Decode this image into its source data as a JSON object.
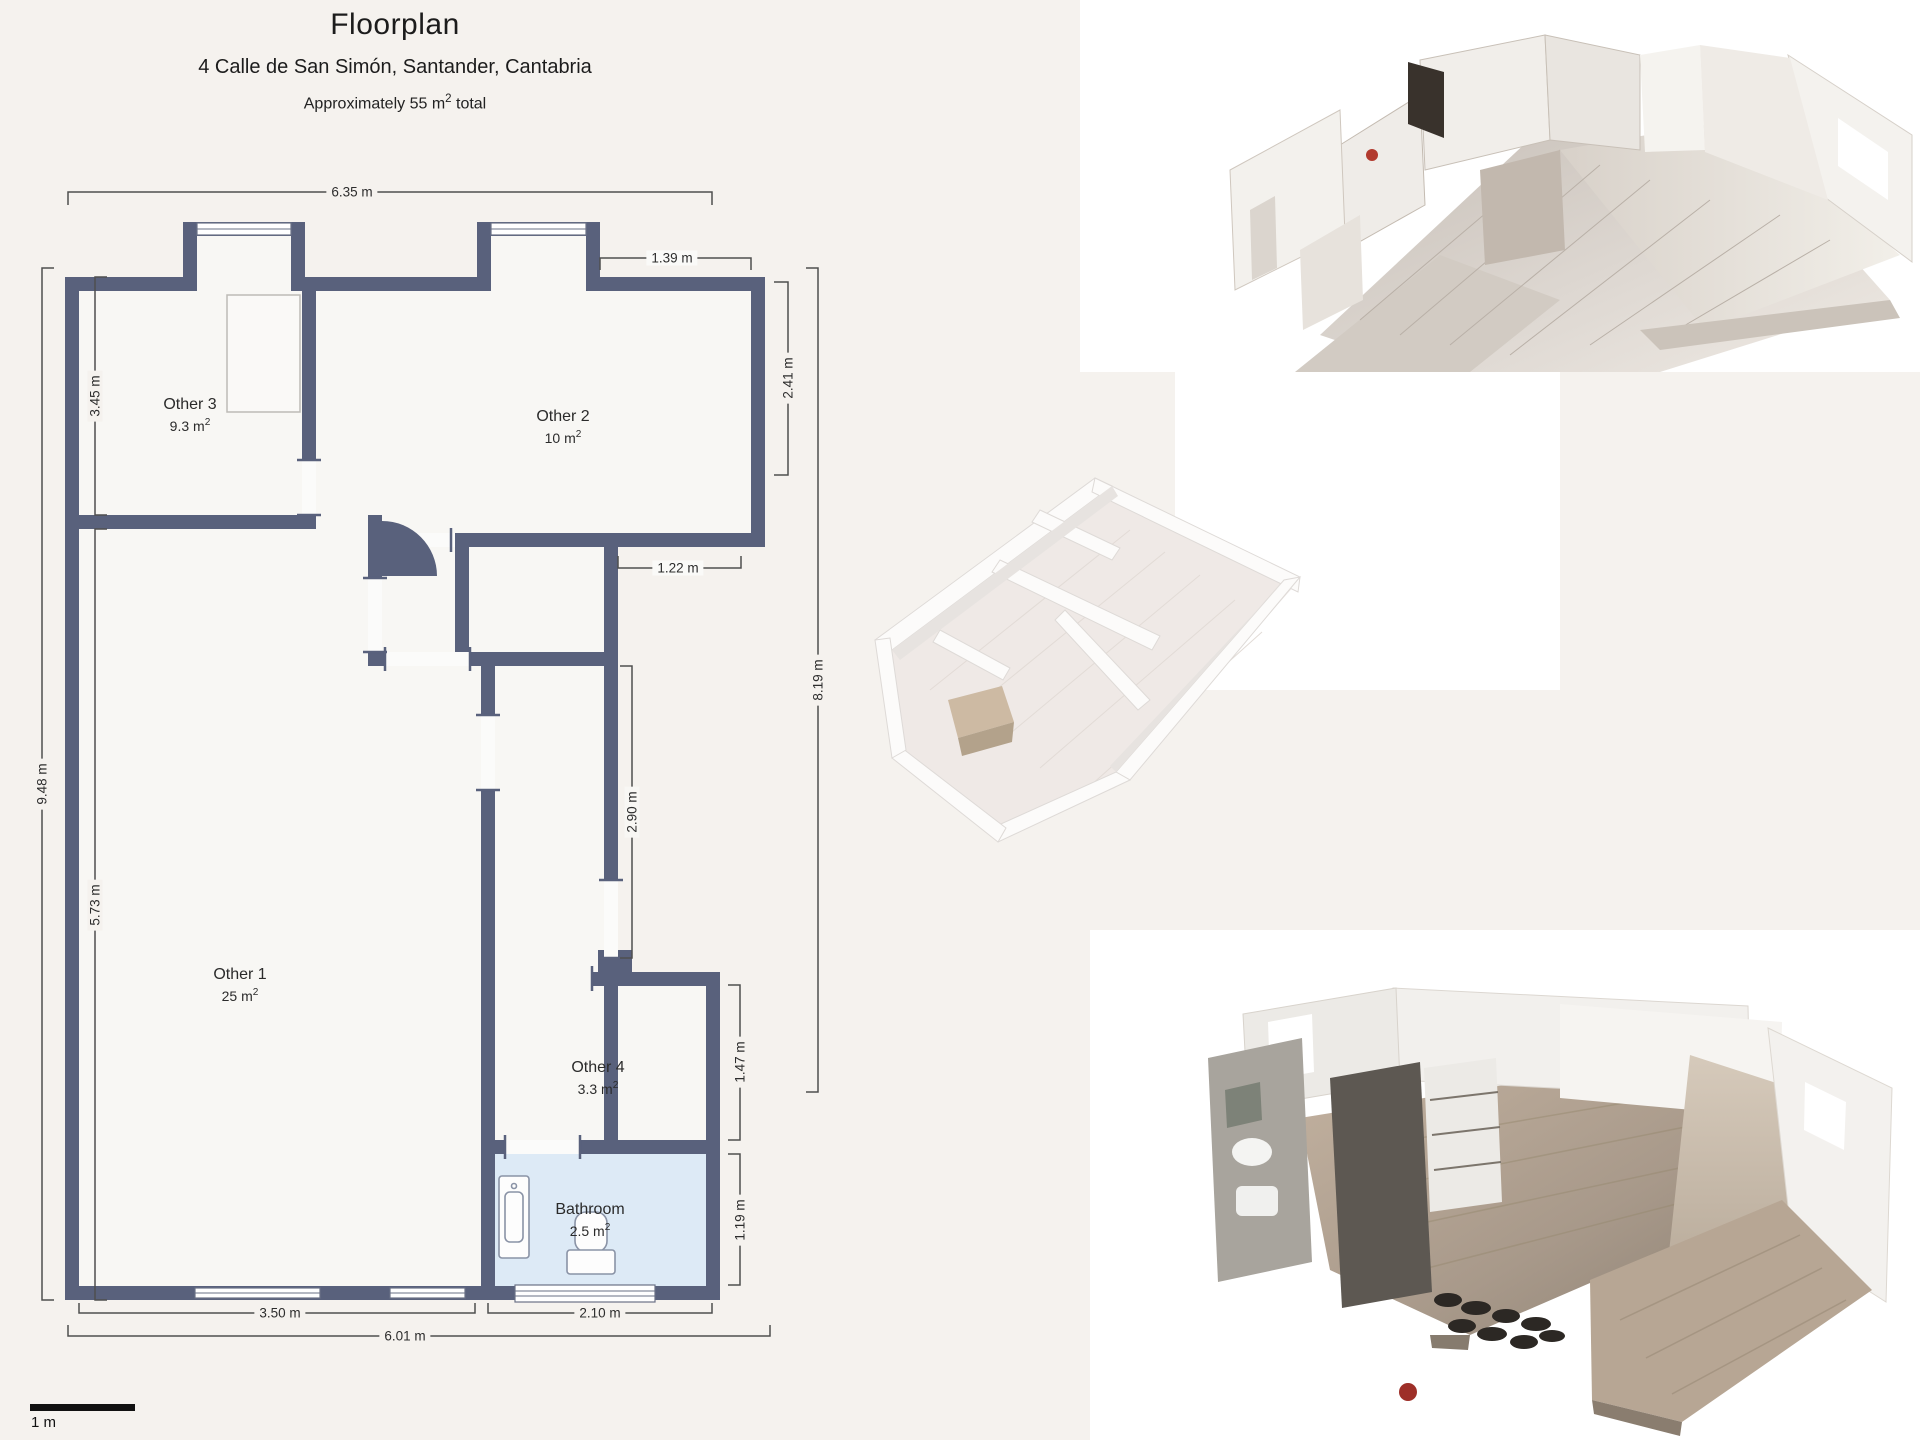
{
  "header": {
    "title": "Floorplan",
    "address": "4 Calle de San Simón, Santander, Cantabria",
    "area_total": {
      "prefix": "Approximately 55 m",
      "sup": "2",
      "suffix": " total"
    }
  },
  "floorplan": {
    "wall_color": "#59617c",
    "room_fill": "#f8f7f4",
    "bathroom_fill": "#ddeaf6",
    "dim_line_color": "#4f4f4f",
    "rooms": [
      {
        "name": "Other 3",
        "area_value": "9.3 m",
        "area_sup": "2"
      },
      {
        "name": "Other 2",
        "area_value": "10 m",
        "area_sup": "2"
      },
      {
        "name": "Other 1",
        "area_value": "25 m",
        "area_sup": "2"
      },
      {
        "name": "Other 4",
        "area_value": "3.3 m",
        "area_sup": "2"
      },
      {
        "name": "Bathroom",
        "area_value": "2.5 m",
        "area_sup": "2"
      }
    ],
    "dimensions": [
      {
        "label": "6.35 m"
      },
      {
        "label": "1.39 m"
      },
      {
        "label": "3.45 m"
      },
      {
        "label": "2.41 m"
      },
      {
        "label": "1.22 m"
      },
      {
        "label": "9.48 m"
      },
      {
        "label": "2.90 m"
      },
      {
        "label": "8.19 m"
      },
      {
        "label": "5.73 m"
      },
      {
        "label": "1.47 m"
      },
      {
        "label": "1.19 m"
      },
      {
        "label": "3.50 m"
      },
      {
        "label": "2.10 m"
      },
      {
        "label": "6.01 m"
      }
    ],
    "scale_bar": {
      "label": "1 m"
    },
    "fixtures": [
      "sink-vanity",
      "toilet"
    ]
  },
  "views": {
    "view1": {
      "name": "textured 3D dollhouse view (top right)",
      "floor_color": "#cfc8c1"
    },
    "view2": {
      "name": "white 3D model view (middle)",
      "floor_color": "#efe9e6"
    },
    "view3": {
      "name": "textured 3D dollhouse view (bottom right)",
      "floor_color": "#b3a292"
    }
  }
}
